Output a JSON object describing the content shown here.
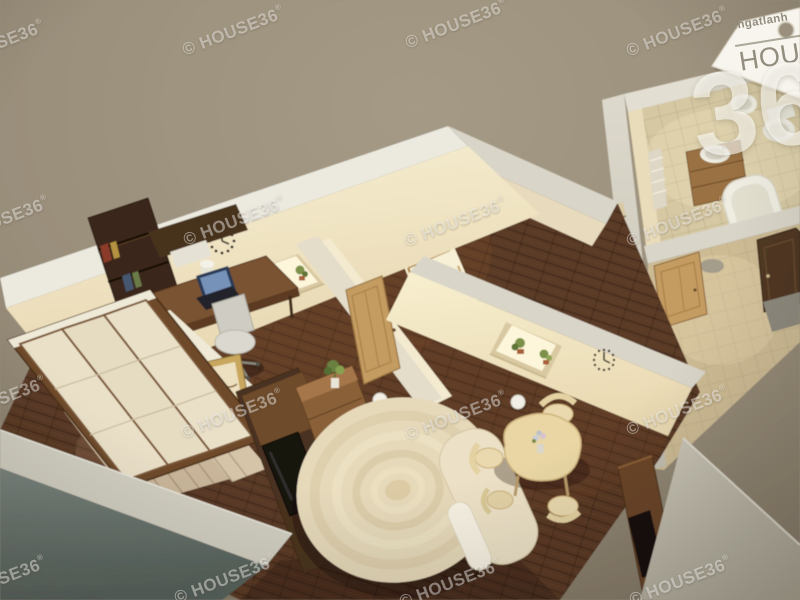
{
  "page": {
    "title": "HOUSE36 3D floor plan render"
  },
  "watermark": {
    "text": "© HOUSE36",
    "suffix": "®",
    "angle_deg": -21,
    "positions": [
      [
        -57,
        54
      ],
      [
        183,
        40
      ],
      [
        406,
        33
      ],
      [
        627,
        41
      ],
      [
        -52,
        230
      ],
      [
        184,
        230
      ],
      [
        405,
        231
      ],
      [
        627,
        231
      ],
      [
        -55,
        410
      ],
      [
        182,
        423
      ],
      [
        406,
        425
      ],
      [
        627,
        420
      ],
      [
        -55,
        590
      ],
      [
        175,
        588
      ],
      [
        400,
        592
      ],
      [
        630,
        590
      ]
    ]
  },
  "logo": {
    "brand_small": "ingatlanh",
    "brand_large": "HOUS",
    "big_number": "36"
  },
  "palette": {
    "background": "#9a8f7b",
    "floor": "#5a3a26",
    "cream": "#f0e6c8",
    "tile": "#d5c8a3",
    "fixture": "#efede2",
    "oak": "#c49c62",
    "walnut": "#4a3320",
    "sofa": "#e6d9ba",
    "bed": "#c9b69a",
    "walltop": "#d9d5c8",
    "front": "#747e77",
    "wm": "rgba(255,255,255,0.42)",
    "logo_text": "#928d7e",
    "logo_number": "rgba(255,253,247,0.62)"
  },
  "scene": {
    "type": "3d-apartment-cutaway-render",
    "rooms": [
      "office",
      "bedroom",
      "living-room",
      "dining-area",
      "bathroom",
      "hallway"
    ]
  }
}
